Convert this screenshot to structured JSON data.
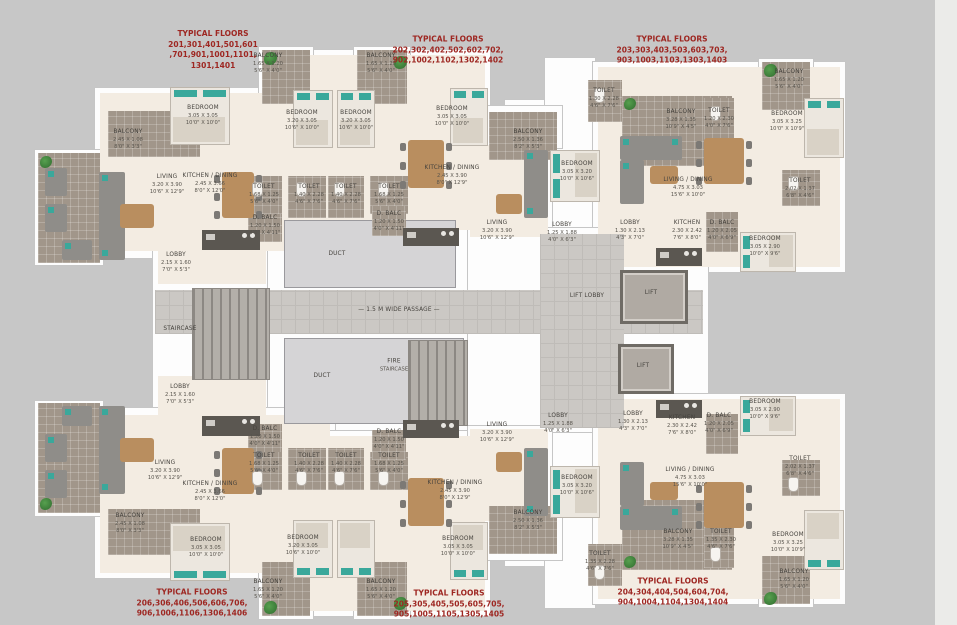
{
  "colors": {
    "red_text": "#9e2722",
    "label_text": "#45423d",
    "teal_accent": "#3aa89b",
    "cream_floor": "#f3ece2",
    "taupe_tile": "#a1968a",
    "wall": "#fdfdfd",
    "background": "#c7c7c7"
  },
  "annotations": [
    {
      "x": 213,
      "y": 50,
      "lines": [
        "TYPICAL FLOORS",
        "201,301,401,501,601",
        ",701,901,1001,1101,",
        "1301,1401"
      ]
    },
    {
      "x": 448,
      "y": 50,
      "lines": [
        "TYPICAL FLOORS",
        "202,302,402,502,602,702,",
        "902,1002,1102,1302,1402"
      ]
    },
    {
      "x": 672,
      "y": 50,
      "lines": [
        "TYPICAL FLOORS",
        "203,303,403,503,603,703,",
        "903,1003,1103,1303,1403"
      ]
    },
    {
      "x": 192,
      "y": 603,
      "lines": [
        "TYPICAL FLOORS",
        "206,306,406,506,606,706,",
        "906,1006,1106,1306,1406"
      ]
    },
    {
      "x": 449,
      "y": 604,
      "lines": [
        "TYPICAL FLOORS",
        "205,305,405,505,605,705,",
        "905,1005,1105,1305,1405"
      ]
    },
    {
      "x": 673,
      "y": 592,
      "lines": [
        "TYPICAL FLOORS",
        "204,304,404,504,604,704,",
        "904,1004,1104,1304,1404"
      ]
    }
  ],
  "rooms": [
    {
      "n": "BALCONY",
      "m": "2.45 X 1.08",
      "f": "8'0\" X 3'3\"",
      "x": 128,
      "y": 140
    },
    {
      "n": "BEDROOM",
      "m": "3.05 X 3.05",
      "f": "10'0\" X 10'0\"",
      "x": 203,
      "y": 116
    },
    {
      "n": "BEDROOM",
      "m": "3.20 X 3.05",
      "f": "10'6\" X 10'0\"",
      "x": 302,
      "y": 121
    },
    {
      "n": "LIVING",
      "m": "3.20 X 3.90",
      "f": "10'6\" X 12'9\"",
      "x": 167,
      "y": 185
    },
    {
      "n": "KITCHEN / DINING",
      "m": "2.45 X 3.66",
      "f": "8'0\" X 12'0\"",
      "x": 210,
      "y": 184
    },
    {
      "n": "TOILET",
      "m": "1.68 X 1.25",
      "f": "5'6\" X 4'0\"",
      "x": 264,
      "y": 195
    },
    {
      "n": "TOILET",
      "m": "1.40 X 2.28",
      "f": "4'6\" X 7'6\"",
      "x": 309,
      "y": 195
    },
    {
      "n": "D. BALC",
      "m": "1.20 X 1.50",
      "f": "4'0\" X 4'11\"",
      "x": 265,
      "y": 226
    },
    {
      "n": "LOBBY",
      "m": "2.15 X 1.60",
      "f": "7'0\" X 5'3\"",
      "x": 176,
      "y": 263
    },
    {
      "n": "BALCONY",
      "m": "1.65 X 1.20",
      "f": "5'6\" X 4'0\"",
      "x": 268,
      "y": 64
    },
    {
      "n": "BALCONY",
      "m": "1.65 X 1.20",
      "f": "5'6\" X 4'0\"",
      "x": 381,
      "y": 64
    },
    {
      "n": "BEDROOM",
      "m": "3.20 X 3.05",
      "f": "10'6\" X 10'0\"",
      "x": 356,
      "y": 121
    },
    {
      "n": "BEDROOM",
      "m": "3.05 X 3.05",
      "f": "10'0\" X 10'0\"",
      "x": 452,
      "y": 117
    },
    {
      "n": "TOILET",
      "m": "1.40 X 2.28",
      "f": "4'6\" X 7'6\"",
      "x": 346,
      "y": 195
    },
    {
      "n": "TOILET",
      "m": "1.68 X 1.25",
      "f": "5'6\" X 4'0\"",
      "x": 389,
      "y": 195
    },
    {
      "n": "D. BALC",
      "m": "1.20 X 1.50",
      "f": "4'0\" X 4'11\"",
      "x": 389,
      "y": 222
    },
    {
      "n": "KITCHEN / DINING",
      "m": "2.45 X 3.90",
      "f": "8'0\" X 12'9\"",
      "x": 452,
      "y": 176
    },
    {
      "n": "LIVING",
      "m": "3.20 X 3.90",
      "f": "10'6\" X 12'9\"",
      "x": 497,
      "y": 231
    },
    {
      "n": "BALCONY",
      "m": "2.50 X 1.36",
      "f": "8'2\" X 5'3\"",
      "x": 528,
      "y": 140
    },
    {
      "n": "TOILET",
      "m": "1.30 X 2.28",
      "f": "4'6\" X 7'6\"",
      "x": 604,
      "y": 99
    },
    {
      "n": "BEDROOM",
      "m": "3.05 X 3.20",
      "f": "10'0\" X 10'6\"",
      "x": 577,
      "y": 172
    },
    {
      "n": "LOBBY",
      "m": "1.25 X 1.88",
      "f": "4'0\" X 6'3\"",
      "x": 562,
      "y": 233
    },
    {
      "n": "LOBBY",
      "m": "1.30 X 2.13",
      "f": "4'3\" X 7'0\"",
      "x": 630,
      "y": 231
    },
    {
      "n": "BALCONY",
      "m": "3.28 X 1.35",
      "f": "10'9\" X 4'5\"",
      "x": 681,
      "y": 120
    },
    {
      "n": "TOILET",
      "m": "1.20 X 2.30",
      "f": "4'0\" X 7'6\"",
      "x": 719,
      "y": 119
    },
    {
      "n": "BALCONY",
      "m": "1.65 X 1.20",
      "f": "5'6\" X 4'0\"",
      "x": 789,
      "y": 80
    },
    {
      "n": "BEDROOM",
      "m": "3.05 X 3.25",
      "f": "10'0\" X 10'9\"",
      "x": 787,
      "y": 122
    },
    {
      "n": "LIVING / DINING",
      "m": "4.75 X 3.03",
      "f": "15'6\" X 10'0\"",
      "x": 688,
      "y": 188
    },
    {
      "n": "TOILET",
      "m": "2.02 X 1.37",
      "f": "6'8\" X 4'6\"",
      "x": 800,
      "y": 189
    },
    {
      "n": "KITCHEN",
      "m": "2.30 X 2.42",
      "f": "7'6\" X 8'0\"",
      "x": 687,
      "y": 231
    },
    {
      "n": "D. BALC",
      "m": "1.20 X 2.05",
      "f": "4'0\" X 6'9\"",
      "x": 722,
      "y": 231
    },
    {
      "n": "BEDROOM",
      "m": "3.05 X 2.90",
      "f": "10'0\" X 9'6\"",
      "x": 765,
      "y": 247
    },
    {
      "n": "DUCT",
      "m": "",
      "f": "",
      "x": 337,
      "y": 255
    },
    {
      "n": "DUCT",
      "m": "",
      "f": "",
      "x": 322,
      "y": 377
    },
    {
      "n": "— 1.5 M WIDE PASSAGE —",
      "m": "",
      "f": "",
      "x": 399,
      "y": 311
    },
    {
      "n": "FIRE",
      "m": "STAIRCASE",
      "f": "",
      "x": 394,
      "y": 366
    },
    {
      "n": "STAIRCASE",
      "m": "",
      "f": "",
      "x": 180,
      "y": 330
    },
    {
      "n": "LOBBY",
      "m": "2.15 X 1.60",
      "f": "7'0\" X 5'3\"",
      "x": 180,
      "y": 395
    },
    {
      "n": "LIFT LOBBY",
      "m": "",
      "f": "",
      "x": 587,
      "y": 297
    },
    {
      "n": "LIFT",
      "m": "",
      "f": "",
      "x": 651,
      "y": 294
    },
    {
      "n": "LIFT",
      "m": "",
      "f": "",
      "x": 643,
      "y": 367
    },
    {
      "n": "LIVING",
      "m": "3.20 X 3.90",
      "f": "10'6\" X 12'9\"",
      "x": 165,
      "y": 471
    },
    {
      "n": "KITCHEN / DINING",
      "m": "2.45 X 3.66",
      "f": "8'0\" X 12'0\"",
      "x": 210,
      "y": 492
    },
    {
      "n": "D. BALC",
      "m": "1.20 X 1.50",
      "f": "4'0\" X 4'11\"",
      "x": 265,
      "y": 437
    },
    {
      "n": "TOILET",
      "m": "1.68 X 1.25",
      "f": "5'6\" X 4'0\"",
      "x": 264,
      "y": 464
    },
    {
      "n": "TOILET",
      "m": "1.40 X 2.28",
      "f": "4'6\" X 7'6\"",
      "x": 309,
      "y": 464
    },
    {
      "n": "BALCONY",
      "m": "2.45 X 1.08",
      "f": "8'0\" X 3'3\"",
      "x": 130,
      "y": 524
    },
    {
      "n": "BEDROOM",
      "m": "3.05 X 3.05",
      "f": "10'0\" X 10'0\"",
      "x": 206,
      "y": 548
    },
    {
      "n": "BEDROOM",
      "m": "3.20 X 3.05",
      "f": "10'6\" X 10'0\"",
      "x": 303,
      "y": 546
    },
    {
      "n": "TOILET",
      "m": "1.40 X 2.28",
      "f": "4'6\" X 7'6\"",
      "x": 346,
      "y": 464
    },
    {
      "n": "TOILET",
      "m": "1.68 X 1.25",
      "f": "5'6\" X 4'0\"",
      "x": 389,
      "y": 464
    },
    {
      "n": "D. BALC",
      "m": "1.20 X 1.50",
      "f": "4'0\" X 4'11\"",
      "x": 389,
      "y": 440
    },
    {
      "n": "BALCONY",
      "m": "1.65 X 1.20",
      "f": "5'6\" X 4'0\"",
      "x": 268,
      "y": 590
    },
    {
      "n": "BALCONY",
      "m": "1.65 X 1.20",
      "f": "5'6\" X 4'0\"",
      "x": 381,
      "y": 590
    },
    {
      "n": "KITCHEN / DINING",
      "m": "2.45 X 3.90",
      "f": "8'0\" X 12'9\"",
      "x": 455,
      "y": 491
    },
    {
      "n": "BEDROOM",
      "m": "3.05 X 3.05",
      "f": "10'0\" X 10'0\"",
      "x": 458,
      "y": 547
    },
    {
      "n": "LIVING",
      "m": "3.20 X 3.90",
      "f": "10'6\" X 12'9\"",
      "x": 497,
      "y": 433
    },
    {
      "n": "BALCONY",
      "m": "2.50 X 1.36",
      "f": "8'2\" X 5'3\"",
      "x": 528,
      "y": 521
    },
    {
      "n": "TOILET",
      "m": "1.35 X 2.28",
      "f": "4'6\" X 7'6\"",
      "x": 600,
      "y": 562
    },
    {
      "n": "BEDROOM",
      "m": "3.05 X 3.20",
      "f": "10'0\" X 10'6\"",
      "x": 577,
      "y": 486
    },
    {
      "n": "LOBBY",
      "m": "1.25 X 1.88",
      "f": "4'0\" X 6'3\"",
      "x": 558,
      "y": 424
    },
    {
      "n": "LOBBY",
      "m": "1.30 X 2.13",
      "f": "4'3\" X 7'0\"",
      "x": 633,
      "y": 422
    },
    {
      "n": "KITCHEN",
      "m": "2.30 X 2.42",
      "f": "7'6\" X 8'0\"",
      "x": 682,
      "y": 426
    },
    {
      "n": "D. BALC",
      "m": "1.20 X 2.05",
      "f": "4'0\" X 6'9\"",
      "x": 719,
      "y": 424
    },
    {
      "n": "BEDROOM",
      "m": "3.05 X 2.90",
      "f": "10'0\" X 9'6\"",
      "x": 765,
      "y": 410
    },
    {
      "n": "LIVING / DINING",
      "m": "4.75 X 3.03",
      "f": "15'6\" X 10'0\"",
      "x": 690,
      "y": 478
    },
    {
      "n": "BALCONY",
      "m": "3.28 X 1.35",
      "f": "10'9\" X 4'5\"",
      "x": 678,
      "y": 540
    },
    {
      "n": "TOILET",
      "m": "1.35 X 2.30",
      "f": "4'6\" X 7'6\"",
      "x": 721,
      "y": 540
    },
    {
      "n": "BEDROOM",
      "m": "3.05 X 3.25",
      "f": "10'0\" X 10'9\"",
      "x": 788,
      "y": 543
    },
    {
      "n": "TOILET",
      "m": "2.02 X 1.37",
      "f": "6'8\" X 4'6\"",
      "x": 800,
      "y": 467
    },
    {
      "n": "BALCONY",
      "m": "1.65 X 1.20",
      "f": "5'6\" X 4'0\"",
      "x": 794,
      "y": 580
    }
  ]
}
